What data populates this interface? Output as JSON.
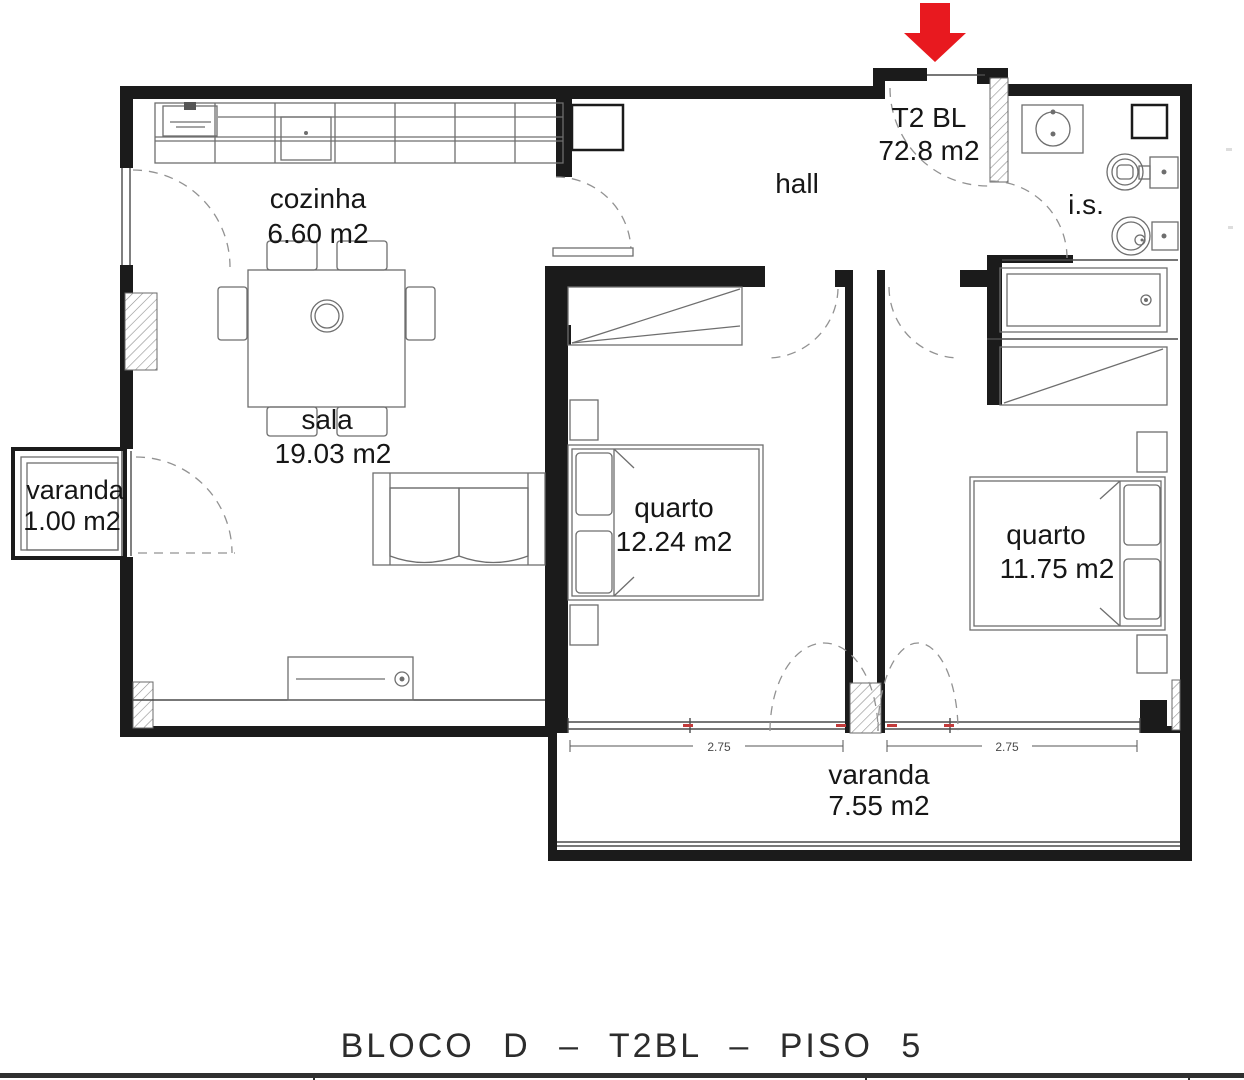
{
  "plan": {
    "unit": {
      "name": "T2 BL",
      "area": "72.8 m2"
    },
    "rooms": [
      {
        "id": "cozinha",
        "name": "cozinha",
        "area": "6.60 m2"
      },
      {
        "id": "sala",
        "name": "sala",
        "area": "19.03 m2"
      },
      {
        "id": "varanda-small",
        "name": "varanda",
        "area": "1.00 m2"
      },
      {
        "id": "hall",
        "name": "hall",
        "area": ""
      },
      {
        "id": "is",
        "name": "i.s.",
        "area": ""
      },
      {
        "id": "quarto-1",
        "name": "quarto",
        "area": "12.24 m2"
      },
      {
        "id": "quarto-2",
        "name": "quarto",
        "area": "11.75 m2"
      },
      {
        "id": "varanda-big",
        "name": "varanda",
        "area": "7.55 m2"
      }
    ],
    "dimensions": [
      {
        "label": "2.75"
      },
      {
        "label": "2.75"
      }
    ],
    "title": "BLOCO D – T2BL – PISO 5",
    "colors": {
      "wall": "#1b1b1b",
      "furniture_line": "#6e6e6e",
      "entrance_arrow": "#e8191f",
      "window_mark_red": "#c23b3b",
      "text": "#161616"
    }
  }
}
